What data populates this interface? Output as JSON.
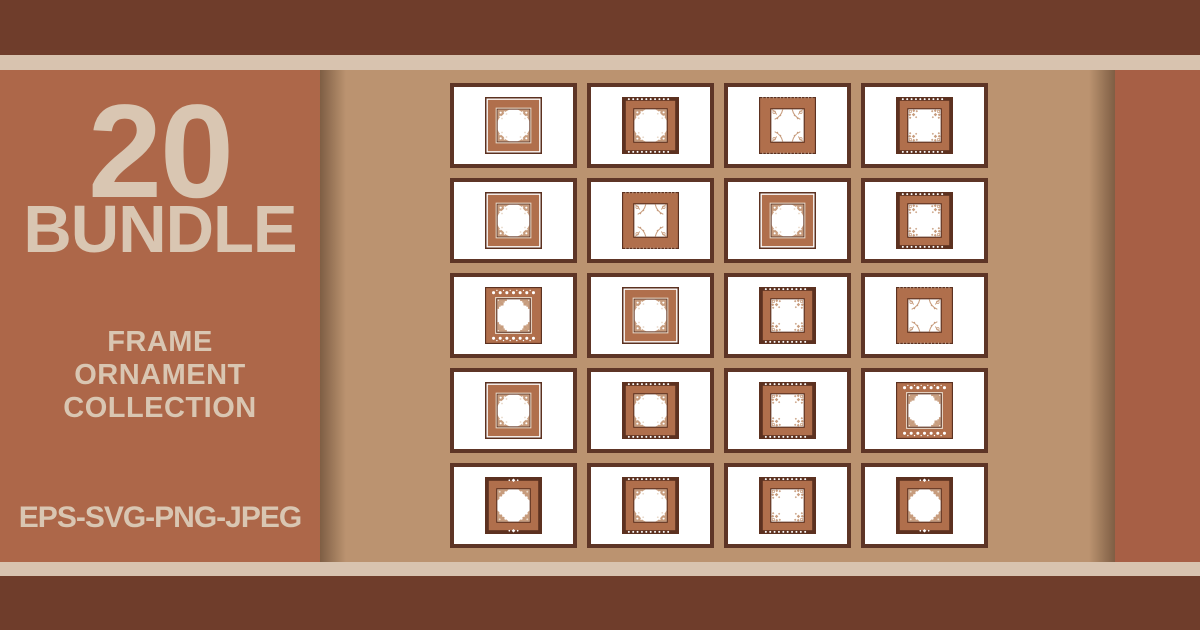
{
  "banner": {
    "count": "20",
    "count_label": "BUNDLE",
    "title_lines": [
      "FRAME",
      "ORNAMENT",
      "COLLECTION"
    ],
    "formats": "EPS-SVG-PNG-JPEG"
  },
  "colors": {
    "bar": "#6f3d2b",
    "stripe": "#d8c3af",
    "cream": "#d9c6b2",
    "left_panel": "#ad6749",
    "right_panel": "#a75f45",
    "grid_bg": "#bb9370",
    "card_border": "#5e3526",
    "frame_dark": "#5c3120",
    "frame_band": "#b06f4c",
    "ornament": "#c79c7d",
    "ornament_light": "#e8d8c8",
    "frame_white": "#ffffff"
  },
  "grid": {
    "columns": 4,
    "rows": 5,
    "frames": [
      {
        "name": "ornament-frame-1",
        "variant": "v1"
      },
      {
        "name": "ornament-frame-2",
        "variant": "v2"
      },
      {
        "name": "ornament-frame-3",
        "variant": "v3"
      },
      {
        "name": "ornament-frame-4",
        "variant": "v4"
      },
      {
        "name": "ornament-frame-5",
        "variant": "v1"
      },
      {
        "name": "ornament-frame-6",
        "variant": "v3"
      },
      {
        "name": "ornament-frame-7",
        "variant": "v1"
      },
      {
        "name": "ornament-frame-8",
        "variant": "v4"
      },
      {
        "name": "ornament-frame-9",
        "variant": "v5"
      },
      {
        "name": "ornament-frame-10",
        "variant": "v1"
      },
      {
        "name": "ornament-frame-11",
        "variant": "v4"
      },
      {
        "name": "ornament-frame-12",
        "variant": "v3"
      },
      {
        "name": "ornament-frame-13",
        "variant": "v1"
      },
      {
        "name": "ornament-frame-14",
        "variant": "v2"
      },
      {
        "name": "ornament-frame-15",
        "variant": "v4"
      },
      {
        "name": "ornament-frame-16",
        "variant": "v5"
      },
      {
        "name": "ornament-frame-17",
        "variant": "v6"
      },
      {
        "name": "ornament-frame-18",
        "variant": "v2"
      },
      {
        "name": "ornament-frame-19",
        "variant": "v4"
      },
      {
        "name": "ornament-frame-20",
        "variant": "v6"
      }
    ]
  }
}
